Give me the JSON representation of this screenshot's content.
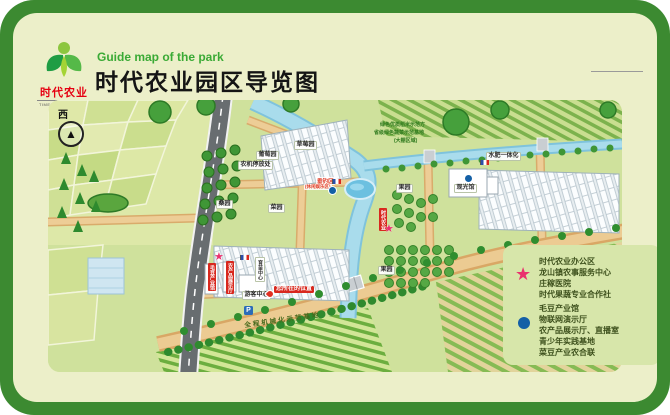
{
  "header": {
    "logo_cn": "时代农业",
    "logo_en": "TIMES AGRICULTURE",
    "subtitle": "Guide map of the park",
    "title": "时代农业园区导览图"
  },
  "compass": "西",
  "colors": {
    "frame_green": "#3c8a31",
    "accent_green": "#3aaa35",
    "logo_red": "#e60012",
    "star_pink": "#e9316e",
    "dot_blue": "#1460a6"
  },
  "map": {
    "labels": [
      {
        "text": "草莓园"
      },
      {
        "text": "葡萄园"
      },
      {
        "text": "农机停放处"
      },
      {
        "text": "垂钓区"
      },
      {
        "text": "(休闲娱乐区)"
      },
      {
        "text": "桑园"
      },
      {
        "text": "菜园"
      },
      {
        "text": "果园"
      },
      {
        "text": "果园"
      },
      {
        "text": "水肥一体化"
      },
      {
        "text": "观光馆"
      },
      {
        "text": "游客中心"
      },
      {
        "text": "您所在的位置"
      },
      {
        "text": "全程机械化示范基地"
      },
      {
        "text": "绿色优质稻米示范方"
      },
      {
        "text": "省级绿色蔬菜示范基地"
      },
      {
        "text": "(大棚区域)"
      },
      {
        "text": "时代农业"
      },
      {
        "text": "毛豆产业馆"
      },
      {
        "text": "农产品展示厅"
      },
      {
        "text": "育苗中心"
      },
      {
        "text": "P"
      }
    ]
  },
  "legend": {
    "star_items": [
      "时代农业办公区",
      "龙山镇农事服务中心",
      "庄稼医院",
      "时代果蔬专业合作社"
    ],
    "dot_items": [
      "毛豆产业馆",
      "物联网演示厅",
      "农产品展示厅、直播室",
      "青少年实践基地",
      "菜豆产业农合联"
    ]
  }
}
